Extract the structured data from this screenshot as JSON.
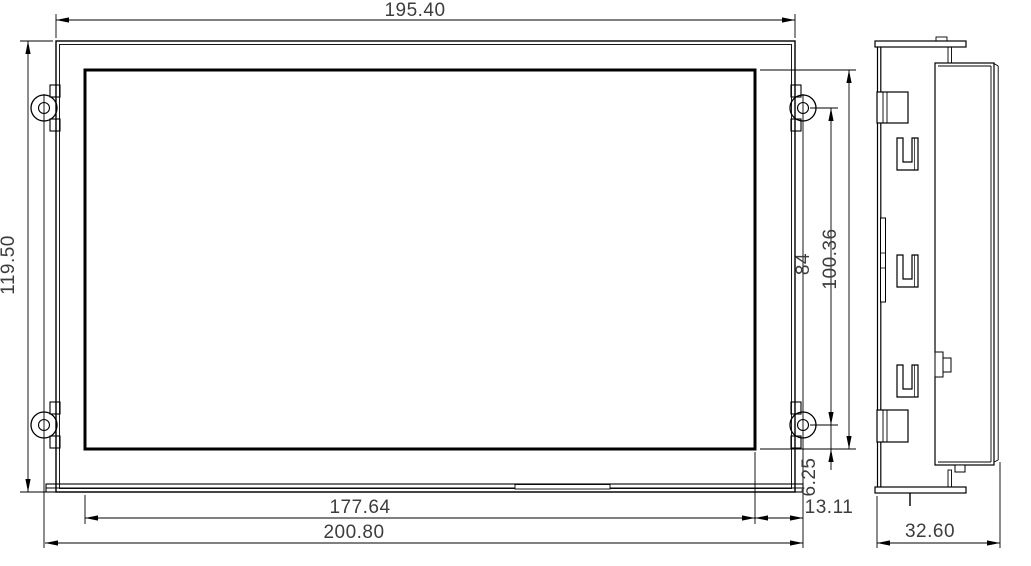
{
  "drawing": {
    "title": "display-module-dimension-drawing",
    "colors": {
      "line": "#000000",
      "dimension_text": "#3d3d3d",
      "background": "#ffffff"
    },
    "dimensions": {
      "bezel_width": "195.40",
      "bezel_height": "119.50",
      "active_width": "177.64",
      "overall_width": "200.80",
      "active_height": "100.36",
      "hole_spacing_vertical": "84",
      "hole_offset_bottom": "6.25",
      "hole_offset_right": "13.11",
      "depth": "32.60"
    }
  }
}
